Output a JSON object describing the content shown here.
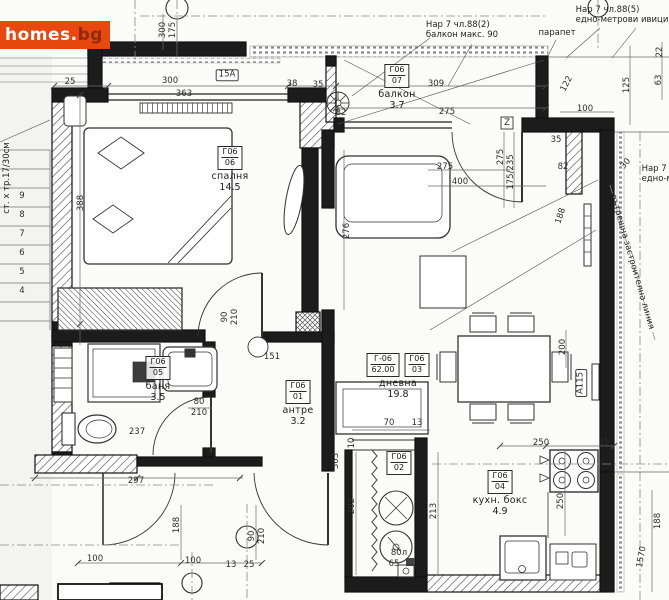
{
  "logo": {
    "main": "homes.",
    "suffix": "bg",
    "bg_color": "#e8470e",
    "main_color": "#ffffff",
    "suffix_color": "#8e2c06"
  },
  "notes": [
    {
      "id": "rule-882",
      "text": "Нар 7 чл.88(2)\nбалкон макс. 90",
      "x": 462,
      "y": 30,
      "rot": 0
    },
    {
      "id": "parapet",
      "text": "парапет",
      "x": 557,
      "y": 33,
      "rot": 0
    },
    {
      "id": "rule-885",
      "text": "Нар 7 чл.88(5)\nедно-метрови ивици",
      "x": 622,
      "y": 15,
      "rot": 0
    },
    {
      "id": "rule-885-right",
      "text": "Нар 7 ч\nедно-м",
      "x": 658,
      "y": 174,
      "rot": 0
    },
    {
      "id": "building-line",
      "text": "вътрешна застроителна линия",
      "x": 632,
      "y": 262,
      "rot": 74
    },
    {
      "id": "stairs-note",
      "text": "ст. х тр.17/30см",
      "x": 7,
      "y": 178,
      "rot": -90
    }
  ],
  "rooms": [
    {
      "id": "balcony",
      "codes": [
        [
          "Г06",
          "07"
        ]
      ],
      "name": "балкон",
      "area": "3.7",
      "x": 397,
      "y": 64
    },
    {
      "id": "bedroom",
      "codes": [
        [
          "Г06",
          "06"
        ]
      ],
      "name": "спалня",
      "area": "14.5",
      "x": 230,
      "y": 146
    },
    {
      "id": "bath",
      "codes": [
        [
          "Г06",
          "05"
        ]
      ],
      "name": "баня",
      "area": "3.5",
      "x": 158,
      "y": 356
    },
    {
      "id": "hall",
      "codes": [
        [
          "Г06",
          "01"
        ]
      ],
      "name": "антре",
      "area": "3.2",
      "x": 298,
      "y": 380
    },
    {
      "id": "living",
      "codes": [
        [
          "Г-06",
          "62.00"
        ],
        [
          "Г06",
          "03"
        ]
      ],
      "name": "дневна",
      "area": "19.8",
      "x": 398,
      "y": 353
    },
    {
      "id": "kitchen",
      "codes": [
        [
          "Г06",
          "04"
        ]
      ],
      "name": "кухн. бокс",
      "area": "4.9",
      "x": 500,
      "y": 470
    },
    {
      "id": "shaft",
      "codes": [
        [
          "Г06",
          "02"
        ]
      ],
      "name": "",
      "area": "",
      "x": 399,
      "y": 451
    }
  ],
  "dim_labels": [
    {
      "t": "300",
      "x": 170,
      "y": 81
    },
    {
      "t": "363",
      "x": 184,
      "y": 94
    },
    {
      "t": "15А",
      "x": 227,
      "y": 75,
      "b": true
    },
    {
      "t": "38",
      "x": 292,
      "y": 84
    },
    {
      "t": "35",
      "x": 318,
      "y": 85
    },
    {
      "t": "25",
      "x": 70,
      "y": 82
    },
    {
      "t": "309",
      "x": 436,
      "y": 84
    },
    {
      "t": "275",
      "x": 447,
      "y": 112
    },
    {
      "t": "82",
      "x": 341,
      "y": 113
    },
    {
      "t": "300",
      "x": 163,
      "y": 30,
      "r": -90
    },
    {
      "t": "175",
      "x": 173,
      "y": 30,
      "r": -90
    },
    {
      "t": "122",
      "x": 567,
      "y": 84,
      "r": -62
    },
    {
      "t": "100",
      "x": 585,
      "y": 109
    },
    {
      "t": "125",
      "x": 627,
      "y": 85,
      "r": -90
    },
    {
      "t": "63",
      "x": 659,
      "y": 80,
      "r": -90
    },
    {
      "t": "22",
      "x": 660,
      "y": 52,
      "r": -90
    },
    {
      "t": "30",
      "x": 626,
      "y": 164,
      "r": -50
    },
    {
      "t": "35",
      "x": 556,
      "y": 140
    },
    {
      "t": "275",
      "x": 445,
      "y": 167
    },
    {
      "t": "400",
      "x": 460,
      "y": 182
    },
    {
      "t": "275",
      "x": 501,
      "y": 157,
      "r": -90
    },
    {
      "t": "175/235",
      "x": 511,
      "y": 172,
      "r": -90
    },
    {
      "t": "82",
      "x": 563,
      "y": 167
    },
    {
      "t": "188",
      "x": 561,
      "y": 216,
      "r": -72
    },
    {
      "t": "276",
      "x": 347,
      "y": 231,
      "r": -90
    },
    {
      "t": "388",
      "x": 81,
      "y": 203,
      "r": -90
    },
    {
      "t": "90",
      "x": 225,
      "y": 317,
      "r": -90
    },
    {
      "t": "210",
      "x": 235,
      "y": 317,
      "r": -90
    },
    {
      "t": "151",
      "x": 272,
      "y": 357
    },
    {
      "t": "80",
      "x": 199,
      "y": 402
    },
    {
      "t": "210",
      "x": 199,
      "y": 413
    },
    {
      "t": "237",
      "x": 137,
      "y": 432
    },
    {
      "t": "297",
      "x": 136,
      "y": 481
    },
    {
      "t": "200",
      "x": 563,
      "y": 347,
      "r": -90
    },
    {
      "t": "А115",
      "x": 581,
      "y": 383,
      "r": -90,
      "b": true
    },
    {
      "t": "250",
      "x": 541,
      "y": 443
    },
    {
      "t": "35",
      "x": 604,
      "y": 443
    },
    {
      "t": "250",
      "x": 561,
      "y": 501,
      "r": -90
    },
    {
      "t": "70",
      "x": 389,
      "y": 423
    },
    {
      "t": "13",
      "x": 417,
      "y": 423
    },
    {
      "t": "10",
      "x": 352,
      "y": 443,
      "r": -90
    },
    {
      "t": "363",
      "x": 336,
      "y": 461,
      "r": -90
    },
    {
      "t": "202",
      "x": 352,
      "y": 506,
      "r": -90
    },
    {
      "t": "213",
      "x": 434,
      "y": 511,
      "r": -90
    },
    {
      "t": "80л",
      "x": 399,
      "y": 553
    },
    {
      "t": "65",
      "x": 394,
      "y": 564
    },
    {
      "t": "188",
      "x": 658,
      "y": 521,
      "r": -90
    },
    {
      "t": "1570",
      "x": 642,
      "y": 557,
      "r": -80
    },
    {
      "t": "188",
      "x": 177,
      "y": 525,
      "r": -90
    },
    {
      "t": "90",
      "x": 252,
      "y": 536,
      "r": -90
    },
    {
      "t": "210",
      "x": 262,
      "y": 536,
      "r": -90
    },
    {
      "t": "13",
      "x": 231,
      "y": 565
    },
    {
      "t": "25",
      "x": 249,
      "y": 565
    },
    {
      "t": "100",
      "x": 95,
      "y": 559
    },
    {
      "t": "100",
      "x": 193,
      "y": 561
    },
    {
      "t": "Z",
      "x": 507,
      "y": 123
    },
    {
      "t": "9",
      "x": 22,
      "y": 196
    },
    {
      "t": "8",
      "x": 22,
      "y": 215
    },
    {
      "t": "7",
      "x": 22,
      "y": 234
    },
    {
      "t": "6",
      "x": 22,
      "y": 253
    },
    {
      "t": "5",
      "x": 22,
      "y": 272
    },
    {
      "t": "4",
      "x": 22,
      "y": 291
    }
  ]
}
